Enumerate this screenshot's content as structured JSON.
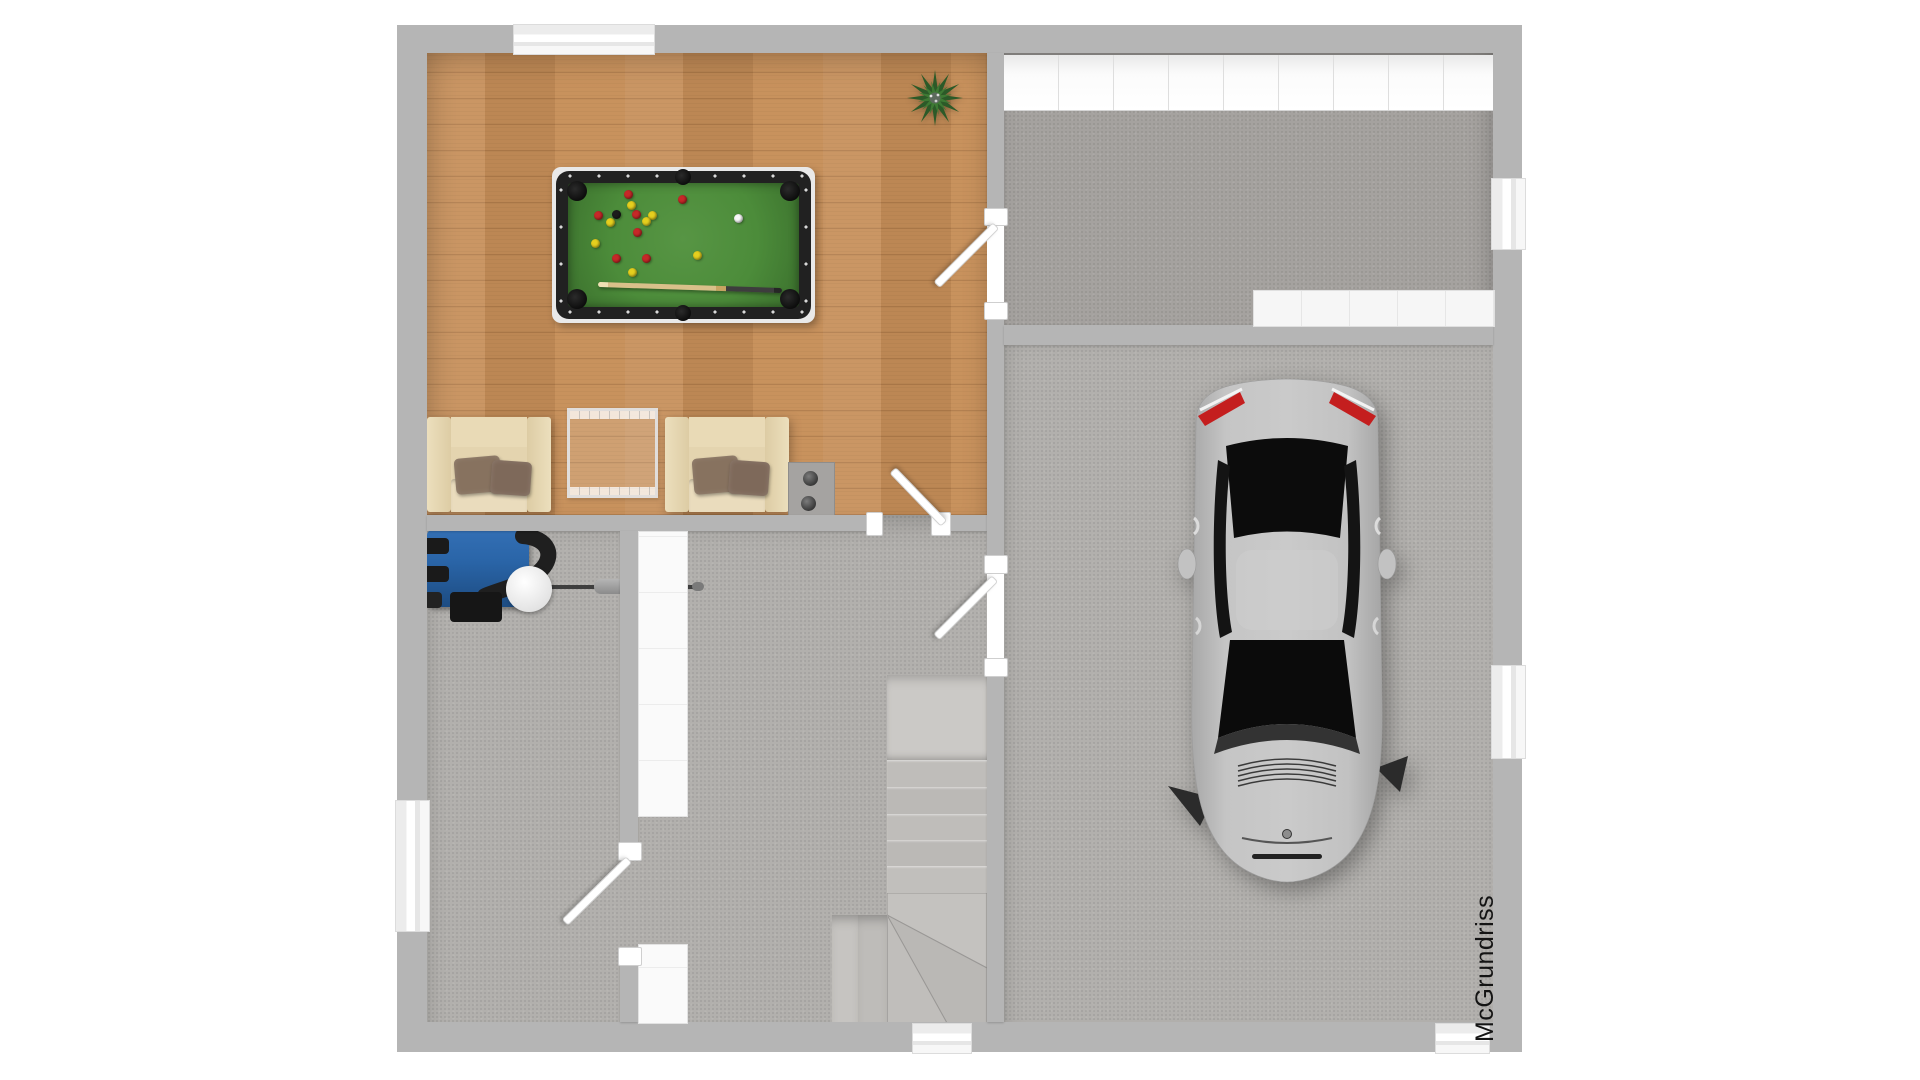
{
  "watermark": {
    "text": "McGrundriss"
  },
  "palette": {
    "wall": "#b5b5b5",
    "outside": "#ffffff",
    "wood_floor": "#c68e58",
    "concrete": "#b2b0ad",
    "concrete_dark": "#a5a29f",
    "felt_green": "#4c8c3a",
    "table_rail": "#212121",
    "boiler_blue": "#2a65a8",
    "taillight_red": "#c41e1e",
    "chair_cream": "#e4d4af",
    "pillow_brown": "#87725f",
    "car_body": "#c3c3c3",
    "plant_green": "#2f5d2a"
  },
  "scene": {
    "type": "floor-plan-top-view-3d-render",
    "rooms": [
      {
        "id": "games-room",
        "floor": "wood"
      },
      {
        "id": "workshop-room",
        "floor": "concrete"
      },
      {
        "id": "garage",
        "floor": "concrete"
      },
      {
        "id": "hallway",
        "floor": "concrete"
      },
      {
        "id": "boiler-room",
        "floor": "concrete"
      }
    ],
    "objects": [
      "pool-table",
      "billiard-cue",
      "billiard-balls",
      "armchair-left",
      "armchair-right",
      "glass-side-table",
      "chimney-block",
      "potted-plant",
      "boiler-unit",
      "staircase",
      "car",
      "workbench",
      "garage-door"
    ]
  },
  "pool_table": {
    "ball_colors": {
      "red": "#c62828",
      "yellow": "#e5cf1e",
      "black": "#1c1c1c",
      "white": "#f8f8f8"
    },
    "balls": [
      {
        "x": 628,
        "y": 194,
        "c": "red"
      },
      {
        "x": 682,
        "y": 199,
        "c": "red"
      },
      {
        "x": 598,
        "y": 215,
        "c": "red"
      },
      {
        "x": 636,
        "y": 214,
        "c": "red"
      },
      {
        "x": 637,
        "y": 232,
        "c": "red"
      },
      {
        "x": 616,
        "y": 258,
        "c": "red"
      },
      {
        "x": 646,
        "y": 258,
        "c": "red"
      },
      {
        "x": 631,
        "y": 205,
        "c": "yellow"
      },
      {
        "x": 652,
        "y": 215,
        "c": "yellow"
      },
      {
        "x": 610,
        "y": 222,
        "c": "yellow"
      },
      {
        "x": 646,
        "y": 221,
        "c": "yellow"
      },
      {
        "x": 595,
        "y": 243,
        "c": "yellow"
      },
      {
        "x": 697,
        "y": 255,
        "c": "yellow"
      },
      {
        "x": 632,
        "y": 272,
        "c": "yellow"
      },
      {
        "x": 616,
        "y": 214,
        "c": "black"
      },
      {
        "x": 738,
        "y": 218,
        "c": "white"
      }
    ]
  }
}
